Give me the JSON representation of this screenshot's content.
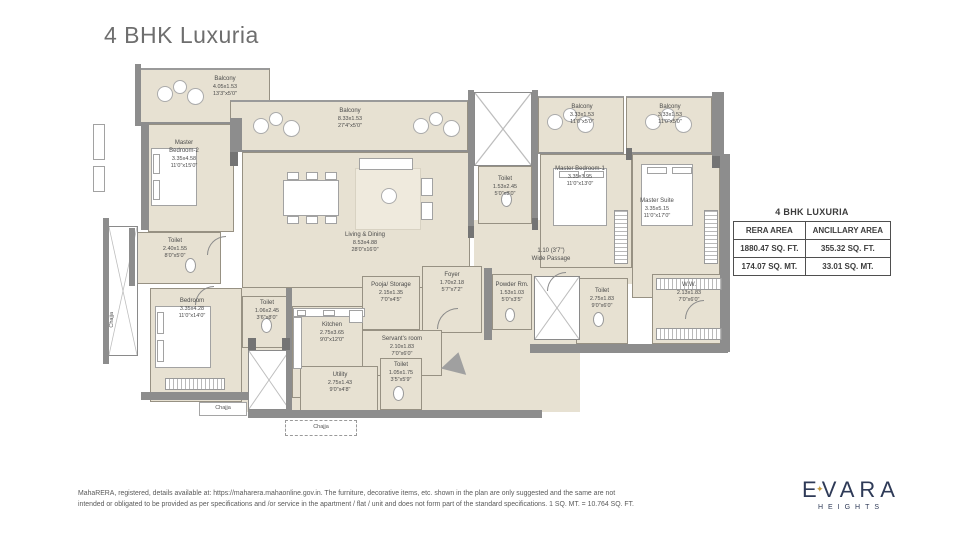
{
  "page": {
    "title": "4 BHK Luxuria"
  },
  "colors": {
    "title_gray": "#6e6e6e",
    "room_beige": "#e7e1d2",
    "wall_gray": "#8d8d8d",
    "brand_navy": "#2e3a57",
    "brand_gold": "#c69b3d"
  },
  "rooms": {
    "balcony_tl": {
      "name": "Balcony",
      "dim_m": "4.05x1.53",
      "dim_ft": "13'3\"x5'0\""
    },
    "balcony_center": {
      "name": "Balcony",
      "dim_m": "8.33x1.53",
      "dim_ft": "27'4\"x5'0\""
    },
    "balcony_r1": {
      "name": "Balcony",
      "dim_m": "3.33x1.53",
      "dim_ft": "11'0\"x5'0\""
    },
    "balcony_r2": {
      "name": "Balcony",
      "dim_m": "3.33x1.53",
      "dim_ft": "11'0\"x5'0\""
    },
    "master_bedroom_2": {
      "name": "Master Bedroom-2",
      "dim_m": "3.35x4.58",
      "dim_ft": "11'0\"x15'0\""
    },
    "living_dining": {
      "name": "Living & Dining",
      "dim_m": "8.53x4.88",
      "dim_ft": "28'0\"x16'0\""
    },
    "toilet_common": {
      "name": "Toilet",
      "dim_m": "1.53x2.45",
      "dim_ft": "5'0\"x8'0\""
    },
    "master_bedroom_1": {
      "name": "Master Bedroom-1",
      "dim_m": "3.35x3.95",
      "dim_ft": "11'0\"x13'0\""
    },
    "master_suite": {
      "name": "Master Suite",
      "dim_m": "3.35x5.15",
      "dim_ft": "11'0\"x17'0\""
    },
    "wide_passage": {
      "name": "Wide Passage",
      "dim_m": "1.10 (3'7\")",
      "dim_ft": ""
    },
    "toilet_left": {
      "name": "Toilet",
      "dim_m": "2.40x1.55",
      "dim_ft": "8'0\"x5'0\""
    },
    "bedroom": {
      "name": "Bedroom",
      "dim_m": "3.35x4.28",
      "dim_ft": "11'0\"x14'0\""
    },
    "toilet_bedroom": {
      "name": "Toilet",
      "dim_m": "1.06x2.45",
      "dim_ft": "3'6\"x8'0\""
    },
    "kitchen": {
      "name": "Kitchen",
      "dim_m": "2.75x3.65",
      "dim_ft": "9'0\"x12'0\""
    },
    "pooja_storage": {
      "name": "Pooja/ Storage",
      "dim_m": "2.15x1.35",
      "dim_ft": "7'0\"x4'5\""
    },
    "foyer": {
      "name": "Foyer",
      "dim_m": "1.70x2.18",
      "dim_ft": "5'7\"x7'2\""
    },
    "servants_room": {
      "name": "Servant's room",
      "dim_m": "2.10x1.83",
      "dim_ft": "7'0\"x6'0\""
    },
    "utility": {
      "name": "Utility",
      "dim_m": "2.75x1.43",
      "dim_ft": "9'0\"x4'8\""
    },
    "toilet_servant": {
      "name": "Toilet",
      "dim_m": "1.05x1.75",
      "dim_ft": "3'5\"x5'9\""
    },
    "powder_room": {
      "name": "Powder Rm.",
      "dim_m": "1.53x1.03",
      "dim_ft": "5'0\"x3'5\""
    },
    "toilet_master": {
      "name": "Toilet",
      "dim_m": "2.75x1.83",
      "dim_ft": "9'0\"x6'0\""
    },
    "ww": {
      "name": "W.W.",
      "dim_m": "2.13x1.83",
      "dim_ft": "7'0\"x6'0\""
    }
  },
  "labels": {
    "chajja": "Chajja"
  },
  "area_table": {
    "title": "4 BHK LUXURIA",
    "columns": [
      "RERA AREA",
      "ANCILLARY AREA"
    ],
    "rows": [
      [
        "1880.47 SQ. FT.",
        "355.32 SQ. FT."
      ],
      [
        "174.07 SQ. MT.",
        "33.01 SQ. MT."
      ]
    ]
  },
  "footer": {
    "disclaimer": "MahaRERA, registered, details available at: https://maharera.mahaonline.gov.in. The furniture, decorative items, etc. shown in the plan are only suggested and the same are not intended or obligated to be provided as per specifications and /or service in the apartment / flat / unit and does not form part of the standard specifications. 1 SQ. MT. = 10.764 SQ. FT."
  },
  "logo": {
    "brand": "EVARA",
    "sub": "HEIGHTS",
    "star": "✦"
  }
}
